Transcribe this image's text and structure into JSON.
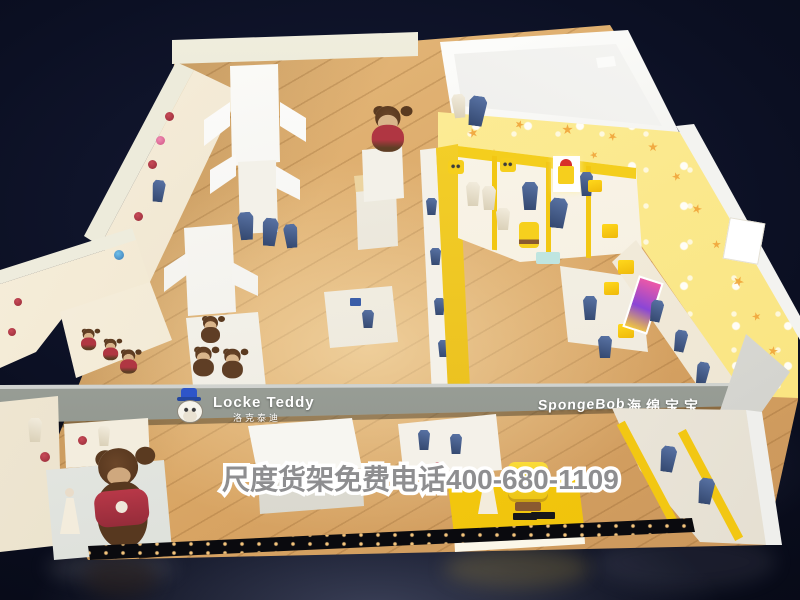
{
  "scene": {
    "description": "3D isometric render of a children's clothing store with two brand zones on a dark showroom backdrop",
    "left_section": "Locke Teddy zone with white shelving and teddy bear mascots",
    "right_section": "SpongeBob zone with yellow star wallpaper and character displays"
  },
  "signs": {
    "locke_teddy": {
      "label": "Locke Teddy",
      "label_cn": "洛克泰迪"
    },
    "spongebob": {
      "label": "SpongeBob",
      "label_cn": "海绵宝宝"
    }
  },
  "watermark": {
    "text": "尺度货架免费电话400-680-1109"
  },
  "palette": {
    "backdrop": "#0b0f22",
    "wood_floor": "#d8a463",
    "fascia_gray": "#9da29b",
    "top_beam_cream": "#eceadb",
    "brand_yellow": "#f6d01e",
    "wallpaper_yellow": "#fdf0a2",
    "shelf_white": "#f4f0e6",
    "teddy_brown": "#5f3e25",
    "sweater_red": "#ab2f3f",
    "denim_blue": "#3c5583",
    "star_orange": "#f0a43a"
  }
}
